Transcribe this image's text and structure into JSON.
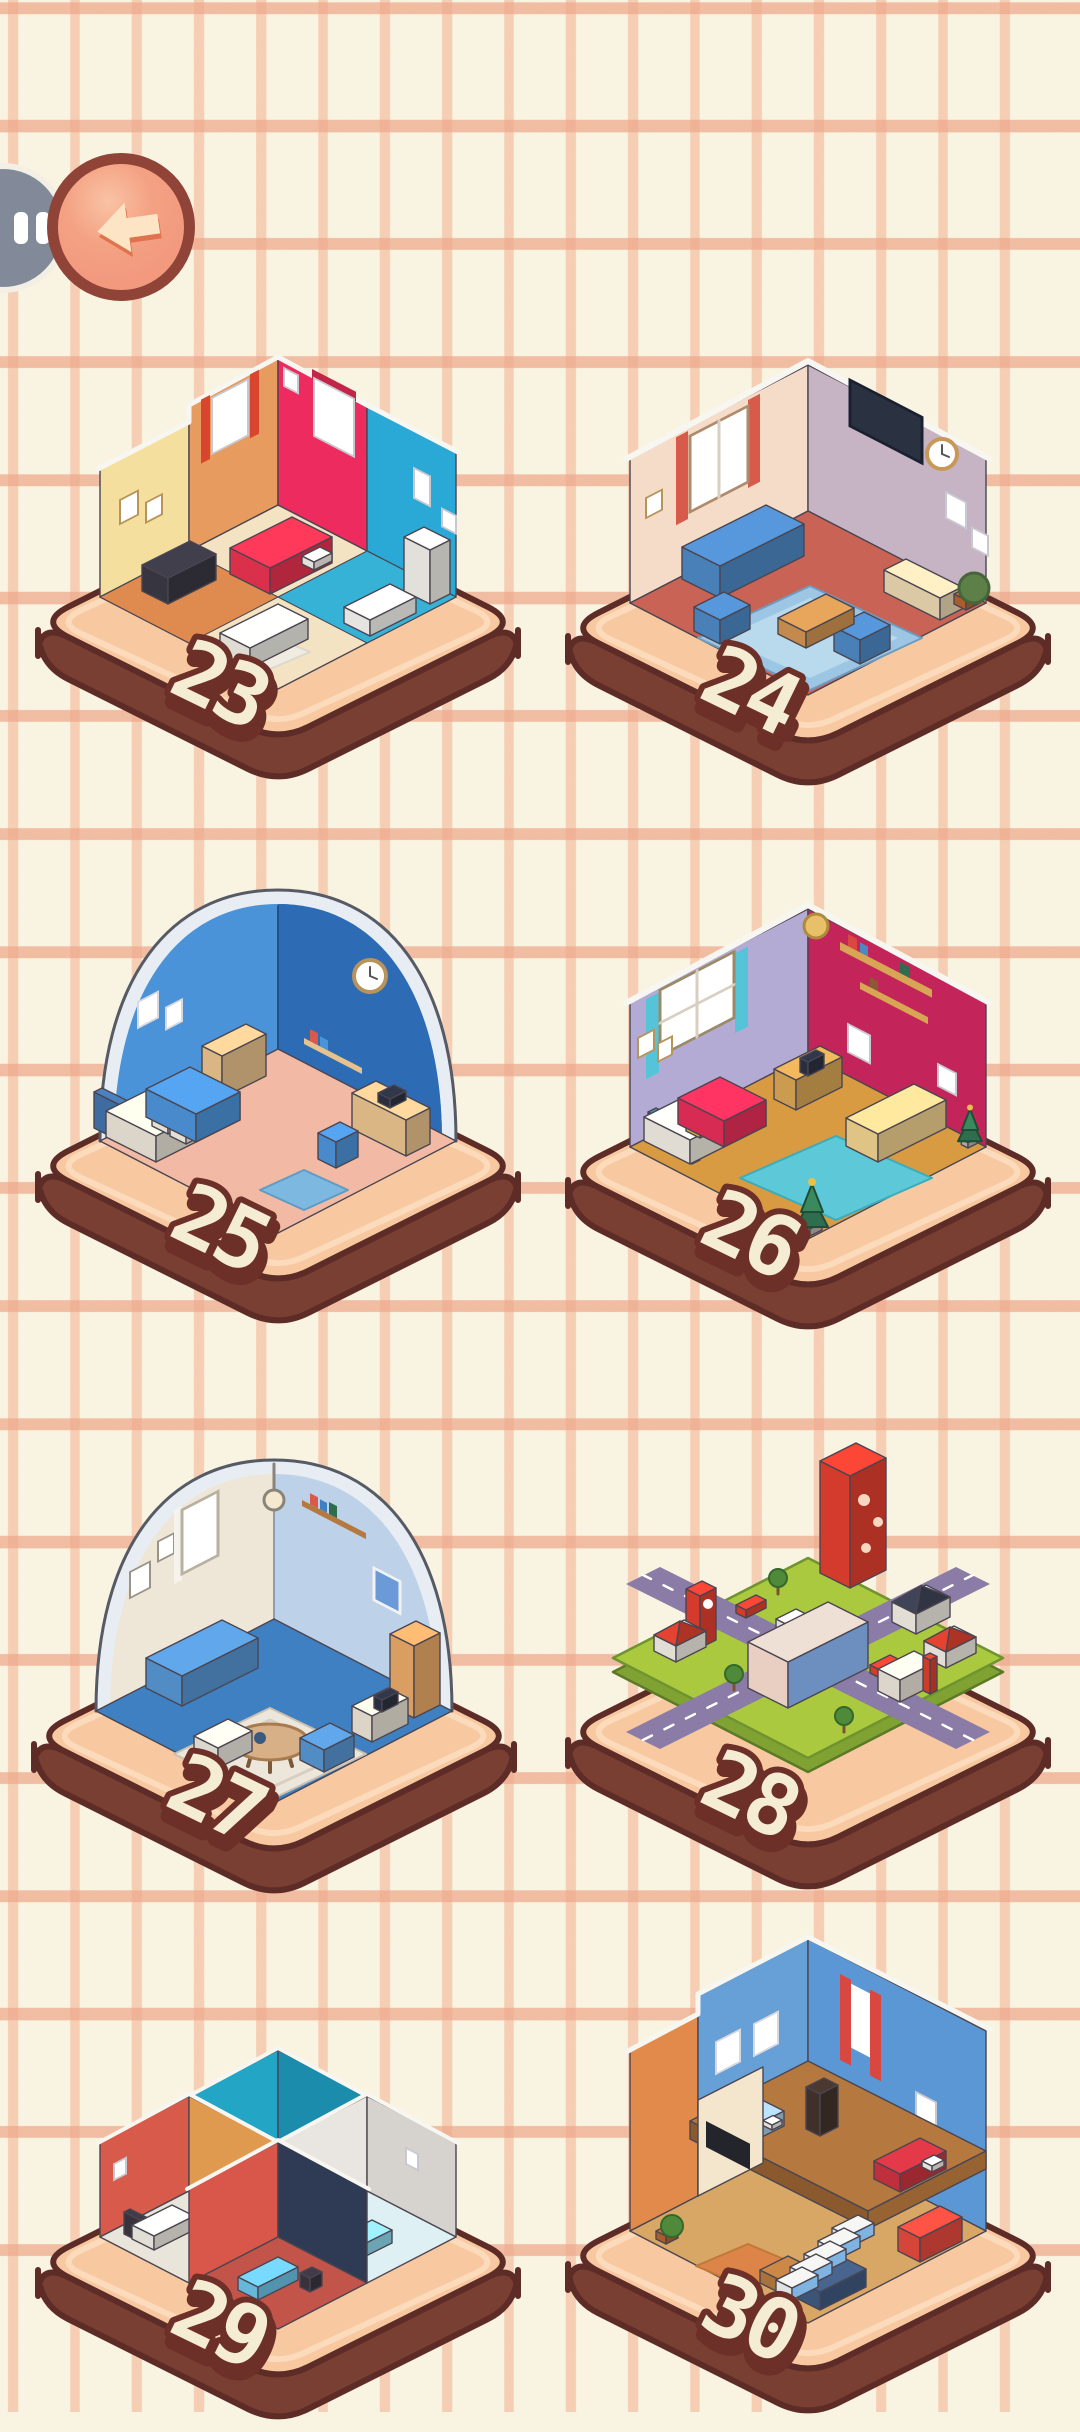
{
  "screen": {
    "name": "level-select"
  },
  "palette": {
    "background": "#f9f3e2",
    "grid_line": "#f0b496",
    "platform_top": "#f8c9a1",
    "platform_rim": "#fcdcbf",
    "platform_side": "#7a3f33",
    "platform_outline": "#5e2c27",
    "badge_fill": "#f5ecd4",
    "badge_outline": "#6d3028",
    "back_button_fill": "#f2997e",
    "back_button_border": "#8f4437",
    "back_arrow": "#fde4c4",
    "pause_button_fill": "#828a9a"
  },
  "header": {
    "back_button": {
      "icon": "back-arrow-icon"
    },
    "pause_button": {
      "icon": "pause-icon"
    }
  },
  "levels": [
    {
      "number": "23",
      "theme": "studio-apartment",
      "art": {
        "type": "multi",
        "colors": {
          "wallA": "#f4df9e",
          "wallB": "#e79b5e",
          "wallC": "#ee2b5e",
          "wallD": "#2aa9d6",
          "floor": "#f3e3c2",
          "floorLeft": "#df8b50",
          "floorRight": "#35b2d6",
          "bed": "#e83350",
          "sofa": "#edeae2",
          "desk": "#3a3844",
          "tub": "#f4f3ee",
          "wardrobe": "#efeee8",
          "rug": "#f0ece2"
        }
      }
    },
    {
      "number": "24",
      "theme": "living-room",
      "art": {
        "type": "corner",
        "colors": {
          "wallL": "#f4dcc8",
          "wallR": "#c6b4c4",
          "floor": "#c96355",
          "rug": "#9cc6e4",
          "rugInner": "#b9d9ec",
          "sofa": "#4e88c4",
          "table": "#cf9352",
          "console": "#e9d6b0",
          "tv": "#2a3242",
          "curtain": "#d85a4a",
          "plant": "#5d7f48"
        }
      }
    },
    {
      "number": "25",
      "theme": "blue-bedroom-dome",
      "art": {
        "type": "dome",
        "colors": {
          "wallL": "#4a93d8",
          "wallR": "#2d6cb5",
          "rim": "#e7edf3",
          "floor": "#f2baa4",
          "blanket": "#4d93d8",
          "mattress": "#e9e4d6",
          "headboard": "#4273aa",
          "desk": "#e8c28c",
          "chair": "#4d93d8",
          "laptop": "#2c3242",
          "rug": "#7db8e0"
        }
      }
    },
    {
      "number": "26",
      "theme": "christmas-bedroom",
      "art": {
        "type": "xmas",
        "colors": {
          "wallL": "#b4abd4",
          "wallR": "#c3255a",
          "floor": "#d89b42",
          "rug": "#5cc8d8",
          "blanket": "#e62e58",
          "mattress": "#eeeae0",
          "headboard": "#2e8a9e",
          "sofa": "#eed08e",
          "tree": "#2e6e4e",
          "desk": "#d8a555",
          "curtain": "#56c4d8"
        }
      }
    },
    {
      "number": "27",
      "theme": "living-room-dome",
      "art": {
        "type": "dome2",
        "colors": {
          "wallL": "#eee7d8",
          "wallR": "#bdd2e8",
          "rim": "#e7edf3",
          "floor": "#3f80c2",
          "rug": "#ece7da",
          "sofa": "#5795d2",
          "sofa2": "#e9e6dc",
          "wardrobe": "#e8a868",
          "table": "#d8b088"
        }
      }
    },
    {
      "number": "28",
      "theme": "city-block",
      "art": {
        "type": "city",
        "colors": {
          "grass": "#aac93f",
          "grassSide": "#7fa232",
          "road": "#8a7ca6",
          "tower": "#e23f30",
          "building": "#e8cfc2",
          "buildingSide": "#6d8fc0",
          "house": "#f0ece3",
          "roofRed": "#d8402e",
          "roofDark": "#3c4154",
          "store": "#e9e3d9",
          "carRed": "#e04030",
          "carWhite": "#eeeeee",
          "tree": "#4e8a3a"
        }
      }
    },
    {
      "number": "29",
      "theme": "four-room-apartment",
      "art": {
        "type": "quad",
        "colors": {
          "topWallL": "#23a6c6",
          "topWallR": "#1b8cab",
          "topFloor": "#e2a158",
          "leftWallL": "#d85a4a",
          "leftWallR": "#e09a50",
          "leftFloor": "#e9e5da",
          "rightWallL": "#e9e6e1",
          "rightWallR": "#d6d2cd",
          "rightFloor": "#dff0f4",
          "bottomWallL": "#d8564a",
          "bottomWallR": "#2f3b54",
          "bottomFloor": "#c2544a",
          "bedWhite": "#efece3",
          "bedBlue": "#6cc3e8",
          "bedCyan": "#8fd8ec",
          "sofaCyan": "#7ad0e6",
          "dark": "#3a3540",
          "wood": "#b5793f"
        }
      }
    },
    {
      "number": "30",
      "theme": "two-story-house",
      "art": {
        "type": "house",
        "colors": {
          "wallL": "#66a0d6",
          "wallR": "#5b97d4",
          "wallOrange": "#e28a4c",
          "upperFloor": "#b5793f",
          "upperFloorSide": "#8a5a2e",
          "groundFloor": "#d9a765",
          "rug": "#dd8448",
          "bedRed": "#cc3340",
          "bedBlue": "#a9cbe8",
          "bookcase": "#43332c",
          "partition": "#f3e6cd",
          "tv": "#23242c",
          "stair": "#eef0f2",
          "stairSide": "#7fb4e2",
          "sofaRed": "#e34a3e",
          "sofaNavy": "#3f5a80",
          "table": "#b5793f",
          "curtain": "#d84840"
        }
      }
    }
  ]
}
